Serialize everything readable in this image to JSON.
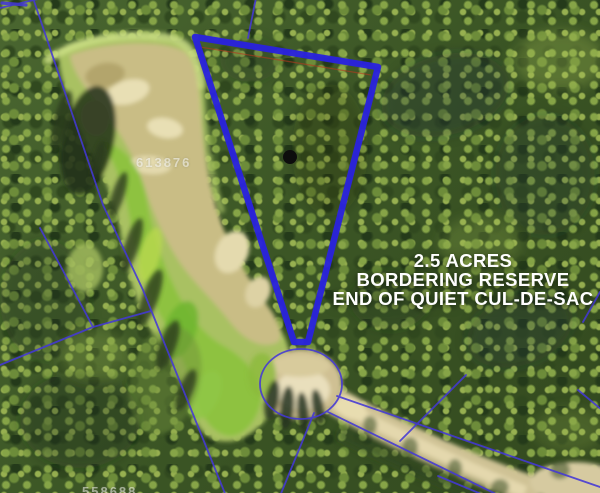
{
  "headline": {
    "line1": "2.5 ACRES",
    "line2": "BORDERING RESERVE",
    "line3": "END OF QUIET CUL-DE-SAC"
  },
  "parcels": {
    "label_main": "613876",
    "label_bottom": "558688"
  },
  "colors": {
    "boundary": "#2a22dd",
    "parcel_line": "#4438d6",
    "boundary_inner_hairline": "#b43a1e",
    "marker": "#0d0d0d",
    "headline_text": "#ffffff",
    "sand": "#cfc295",
    "grass": "#8cc23e"
  }
}
